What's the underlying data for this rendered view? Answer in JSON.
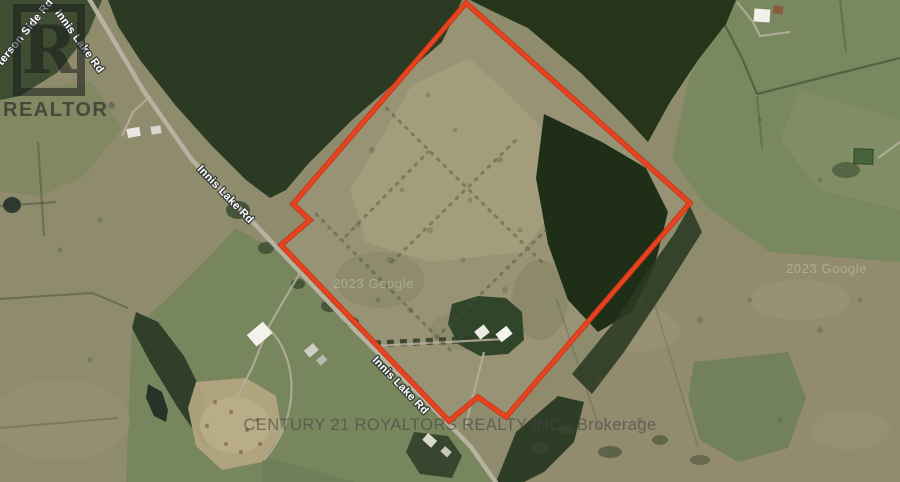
{
  "map": {
    "road_labels": {
      "innis_lake_top": "Innis Lake Rd",
      "side_road_partial": "terson Side Rd",
      "innis_lake_mid": "Innis Lake Rd",
      "innis_lake_bottom": "Innis Lake Rd"
    },
    "attribution_left": "2023 Google",
    "attribution_right": "2023 Google"
  },
  "watermarks": {
    "realtor_block_letter": "R",
    "realtor_wordmark": "REALTOR",
    "registered_symbol": "®",
    "brokerage": "CENTURY 21 ROYALTORS REALTY INC., Brokerage"
  },
  "boundary": {
    "color": "#e8421f",
    "outline_color": "#c23715",
    "points": "466,3 690,203 506,417 478,397 449,421 281,245 310,220 293,204"
  },
  "road": {
    "color": "#bab3a2"
  }
}
